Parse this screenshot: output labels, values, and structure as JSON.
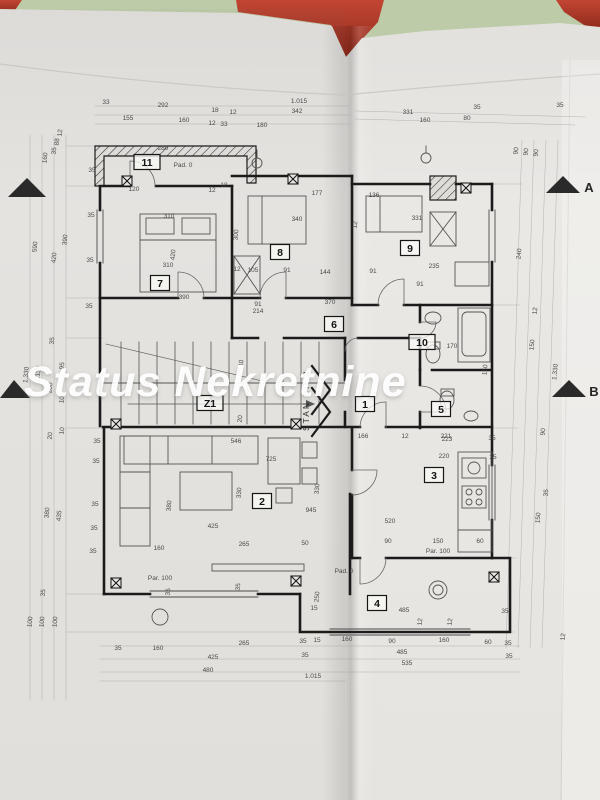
{
  "watermark": {
    "text": "Status Nekretnine",
    "color": "#ffffff"
  },
  "photo": {
    "table_color": "#b8c7a3",
    "folder_color": "#b23a28",
    "paper_color": "#e9e7e4",
    "ink_color": "#3c3c3c",
    "wall_color": "#1b1b1b"
  },
  "plan": {
    "apartment_label": "STAN BR 3",
    "rooms": [
      {
        "number": "11",
        "cx": 147,
        "cy": 162
      },
      {
        "number": "7",
        "cx": 160,
        "cy": 283
      },
      {
        "number": "8",
        "cx": 280,
        "cy": 252
      },
      {
        "number": "9",
        "cx": 410,
        "cy": 248
      },
      {
        "number": "6",
        "cx": 334,
        "cy": 324
      },
      {
        "number": "10",
        "cx": 422,
        "cy": 342
      },
      {
        "number": "Z1",
        "cx": 210,
        "cy": 403
      },
      {
        "number": "1",
        "cx": 365,
        "cy": 404
      },
      {
        "number": "5",
        "cx": 441,
        "cy": 409
      },
      {
        "number": "2",
        "cx": 262,
        "cy": 501
      },
      {
        "number": "3",
        "cx": 434,
        "cy": 475
      },
      {
        "number": "4",
        "cx": 377,
        "cy": 603
      }
    ],
    "section_markers": [
      {
        "label": "A",
        "points": "546,193 580,193 563,176",
        "lx": 589,
        "ly": 192
      },
      {
        "label": "B",
        "points": "552,397 586,397 569,380",
        "lx": 594,
        "ly": 396
      },
      {
        "label": "",
        "points": "8,197 46,197 27,178",
        "lx": 0,
        "ly": 0
      },
      {
        "label": "",
        "points": "0,398 30,398 14,380",
        "lx": 0,
        "ly": 0
      }
    ],
    "dimensions": [
      {
        "t": "33",
        "x": 106,
        "y": 104
      },
      {
        "t": "292",
        "x": 163,
        "y": 107
      },
      {
        "t": "18",
        "x": 215,
        "y": 112
      },
      {
        "t": "12",
        "x": 233,
        "y": 114
      },
      {
        "t": "1.015",
        "x": 299,
        "y": 103
      },
      {
        "t": "342",
        "x": 297,
        "y": 113
      },
      {
        "t": "155",
        "x": 128,
        "y": 120
      },
      {
        "t": "160",
        "x": 184,
        "y": 122
      },
      {
        "t": "12",
        "x": 212,
        "y": 125
      },
      {
        "t": "33",
        "x": 224,
        "y": 126
      },
      {
        "t": "180",
        "x": 262,
        "y": 127
      },
      {
        "t": "331",
        "x": 408,
        "y": 114
      },
      {
        "t": "160",
        "x": 425,
        "y": 122
      },
      {
        "t": "80",
        "x": 467,
        "y": 120
      },
      {
        "t": "35",
        "x": 477,
        "y": 109
      },
      {
        "t": "35",
        "x": 560,
        "y": 107
      },
      {
        "t": "12",
        "x": 62,
        "y": 133,
        "r": -85
      },
      {
        "t": "88",
        "x": 59,
        "y": 142,
        "r": -85
      },
      {
        "t": "35",
        "x": 56,
        "y": 151,
        "r": -85
      },
      {
        "t": "160",
        "x": 47,
        "y": 158,
        "r": -85
      },
      {
        "t": "590",
        "x": 37,
        "y": 247,
        "r": -85
      },
      {
        "t": "390",
        "x": 67,
        "y": 240,
        "r": -85
      },
      {
        "t": "420",
        "x": 56,
        "y": 258,
        "r": -85
      },
      {
        "t": "35",
        "x": 54,
        "y": 341,
        "r": -85
      },
      {
        "t": "95",
        "x": 64,
        "y": 366,
        "r": -85
      },
      {
        "t": "1.330",
        "x": 28,
        "y": 375,
        "r": -85
      },
      {
        "t": "1.130",
        "x": 40,
        "y": 374,
        "r": -85
      },
      {
        "t": "200",
        "x": 52,
        "y": 388,
        "r": -85
      },
      {
        "t": "100",
        "x": 64,
        "y": 398,
        "r": -85
      },
      {
        "t": "20",
        "x": 52,
        "y": 436,
        "r": -85
      },
      {
        "t": "10",
        "x": 64,
        "y": 431,
        "r": -85
      },
      {
        "t": "380",
        "x": 49,
        "y": 513,
        "r": -85
      },
      {
        "t": "435",
        "x": 61,
        "y": 516,
        "r": -85
      },
      {
        "t": "35",
        "x": 45,
        "y": 593,
        "r": -85
      },
      {
        "t": "100",
        "x": 32,
        "y": 622,
        "r": -85
      },
      {
        "t": "100",
        "x": 44,
        "y": 622,
        "r": -85
      },
      {
        "t": "100",
        "x": 57,
        "y": 622,
        "r": -85
      },
      {
        "t": "35",
        "x": 92,
        "y": 172
      },
      {
        "t": "35",
        "x": 91,
        "y": 217
      },
      {
        "t": "35",
        "x": 90,
        "y": 262
      },
      {
        "t": "35",
        "x": 89,
        "y": 308
      },
      {
        "t": "35",
        "x": 97,
        "y": 443
      },
      {
        "t": "35",
        "x": 96,
        "y": 463
      },
      {
        "t": "35",
        "x": 95,
        "y": 506
      },
      {
        "t": "35",
        "x": 94,
        "y": 530
      },
      {
        "t": "35",
        "x": 93,
        "y": 553
      },
      {
        "t": "280",
        "x": 163,
        "y": 150
      },
      {
        "t": "Pad. 0",
        "x": 183,
        "y": 167
      },
      {
        "t": "120",
        "x": 134,
        "y": 191
      },
      {
        "t": "18",
        "x": 224,
        "y": 187
      },
      {
        "t": "12",
        "x": 212,
        "y": 192
      },
      {
        "t": "310",
        "x": 169,
        "y": 218
      },
      {
        "t": "420",
        "x": 175,
        "y": 255,
        "r": -85
      },
      {
        "t": "310",
        "x": 168,
        "y": 267
      },
      {
        "t": "390",
        "x": 184,
        "y": 299
      },
      {
        "t": "300",
        "x": 238,
        "y": 235,
        "r": -85
      },
      {
        "t": "12",
        "x": 237,
        "y": 271
      },
      {
        "t": "105",
        "x": 253,
        "y": 272
      },
      {
        "t": "91",
        "x": 287,
        "y": 272
      },
      {
        "t": "340",
        "x": 297,
        "y": 221
      },
      {
        "t": "144",
        "x": 325,
        "y": 274
      },
      {
        "t": "91",
        "x": 373,
        "y": 273
      },
      {
        "t": "177",
        "x": 317,
        "y": 195
      },
      {
        "t": "136",
        "x": 374,
        "y": 197
      },
      {
        "t": "12",
        "x": 357,
        "y": 225,
        "r": -85
      },
      {
        "t": "331",
        "x": 417,
        "y": 220
      },
      {
        "t": "235",
        "x": 434,
        "y": 268
      },
      {
        "t": "91",
        "x": 420,
        "y": 286
      },
      {
        "t": "370",
        "x": 330,
        "y": 304
      },
      {
        "t": "91",
        "x": 258,
        "y": 306
      },
      {
        "t": "214",
        "x": 258,
        "y": 313
      },
      {
        "t": "110",
        "x": 243,
        "y": 365,
        "r": -85
      },
      {
        "t": "20",
        "x": 242,
        "y": 419,
        "r": -85
      },
      {
        "t": "166",
        "x": 363,
        "y": 438
      },
      {
        "t": "12",
        "x": 405,
        "y": 438
      },
      {
        "t": "221",
        "x": 446,
        "y": 438
      },
      {
        "t": "35",
        "x": 492,
        "y": 440
      },
      {
        "t": "150",
        "x": 487,
        "y": 370,
        "r": -85
      },
      {
        "t": "170",
        "x": 452,
        "y": 348
      },
      {
        "t": "546",
        "x": 236,
        "y": 443
      },
      {
        "t": "725",
        "x": 271,
        "y": 461
      },
      {
        "t": "380",
        "x": 171,
        "y": 506,
        "r": -85
      },
      {
        "t": "330",
        "x": 241,
        "y": 493,
        "r": -85
      },
      {
        "t": "425",
        "x": 213,
        "y": 528
      },
      {
        "t": "945",
        "x": 311,
        "y": 512
      },
      {
        "t": "330",
        "x": 319,
        "y": 489,
        "r": -85
      },
      {
        "t": "160",
        "x": 159,
        "y": 550
      },
      {
        "t": "265",
        "x": 244,
        "y": 546
      },
      {
        "t": "50",
        "x": 305,
        "y": 545
      },
      {
        "t": "Par. 100",
        "x": 160,
        "y": 580
      },
      {
        "t": "35",
        "x": 170,
        "y": 592,
        "r": -85
      },
      {
        "t": "35",
        "x": 240,
        "y": 587,
        "r": -85
      },
      {
        "t": "223",
        "x": 447,
        "y": 441
      },
      {
        "t": "220",
        "x": 444,
        "y": 458
      },
      {
        "t": "520",
        "x": 390,
        "y": 523
      },
      {
        "t": "90",
        "x": 388,
        "y": 543
      },
      {
        "t": "150",
        "x": 438,
        "y": 543
      },
      {
        "t": "60",
        "x": 480,
        "y": 543
      },
      {
        "t": "Par. 100",
        "x": 438,
        "y": 553
      },
      {
        "t": "35",
        "x": 493,
        "y": 459
      },
      {
        "t": "250",
        "x": 319,
        "y": 597,
        "r": -85
      },
      {
        "t": "15",
        "x": 314,
        "y": 610
      },
      {
        "t": "485",
        "x": 404,
        "y": 612
      },
      {
        "t": "35",
        "x": 505,
        "y": 613
      },
      {
        "t": "Pad. 0",
        "x": 344,
        "y": 573
      },
      {
        "t": "160",
        "x": 347,
        "y": 641
      },
      {
        "t": "90",
        "x": 392,
        "y": 643
      },
      {
        "t": "160",
        "x": 444,
        "y": 642
      },
      {
        "t": "60",
        "x": 488,
        "y": 644
      },
      {
        "t": "35",
        "x": 508,
        "y": 645
      },
      {
        "t": "12",
        "x": 422,
        "y": 622,
        "r": -85
      },
      {
        "t": "12",
        "x": 452,
        "y": 622,
        "r": -85
      },
      {
        "t": "485",
        "x": 402,
        "y": 654
      },
      {
        "t": "35",
        "x": 509,
        "y": 658
      },
      {
        "t": "535",
        "x": 407,
        "y": 665
      },
      {
        "t": "35",
        "x": 118,
        "y": 650
      },
      {
        "t": "160",
        "x": 158,
        "y": 650
      },
      {
        "t": "265",
        "x": 244,
        "y": 645
      },
      {
        "t": "35",
        "x": 303,
        "y": 643
      },
      {
        "t": "15",
        "x": 317,
        "y": 642
      },
      {
        "t": "425",
        "x": 213,
        "y": 659
      },
      {
        "t": "35",
        "x": 305,
        "y": 657
      },
      {
        "t": "480",
        "x": 208,
        "y": 672
      },
      {
        "t": "1.015",
        "x": 313,
        "y": 678
      },
      {
        "t": "90",
        "x": 518,
        "y": 151,
        "r": -85
      },
      {
        "t": "90",
        "x": 528,
        "y": 152,
        "r": -85
      },
      {
        "t": "90",
        "x": 538,
        "y": 153,
        "r": -85
      },
      {
        "t": "240",
        "x": 521,
        "y": 254,
        "r": -85
      },
      {
        "t": "12",
        "x": 537,
        "y": 311,
        "r": -85
      },
      {
        "t": "150",
        "x": 534,
        "y": 345,
        "r": -85
      },
      {
        "t": "1.330",
        "x": 557,
        "y": 372,
        "r": -85
      },
      {
        "t": "90",
        "x": 545,
        "y": 432,
        "r": -85
      },
      {
        "t": "35",
        "x": 548,
        "y": 493,
        "r": -85
      },
      {
        "t": "150",
        "x": 540,
        "y": 518,
        "r": -85
      },
      {
        "t": "12",
        "x": 565,
        "y": 637,
        "r": -85
      }
    ]
  }
}
